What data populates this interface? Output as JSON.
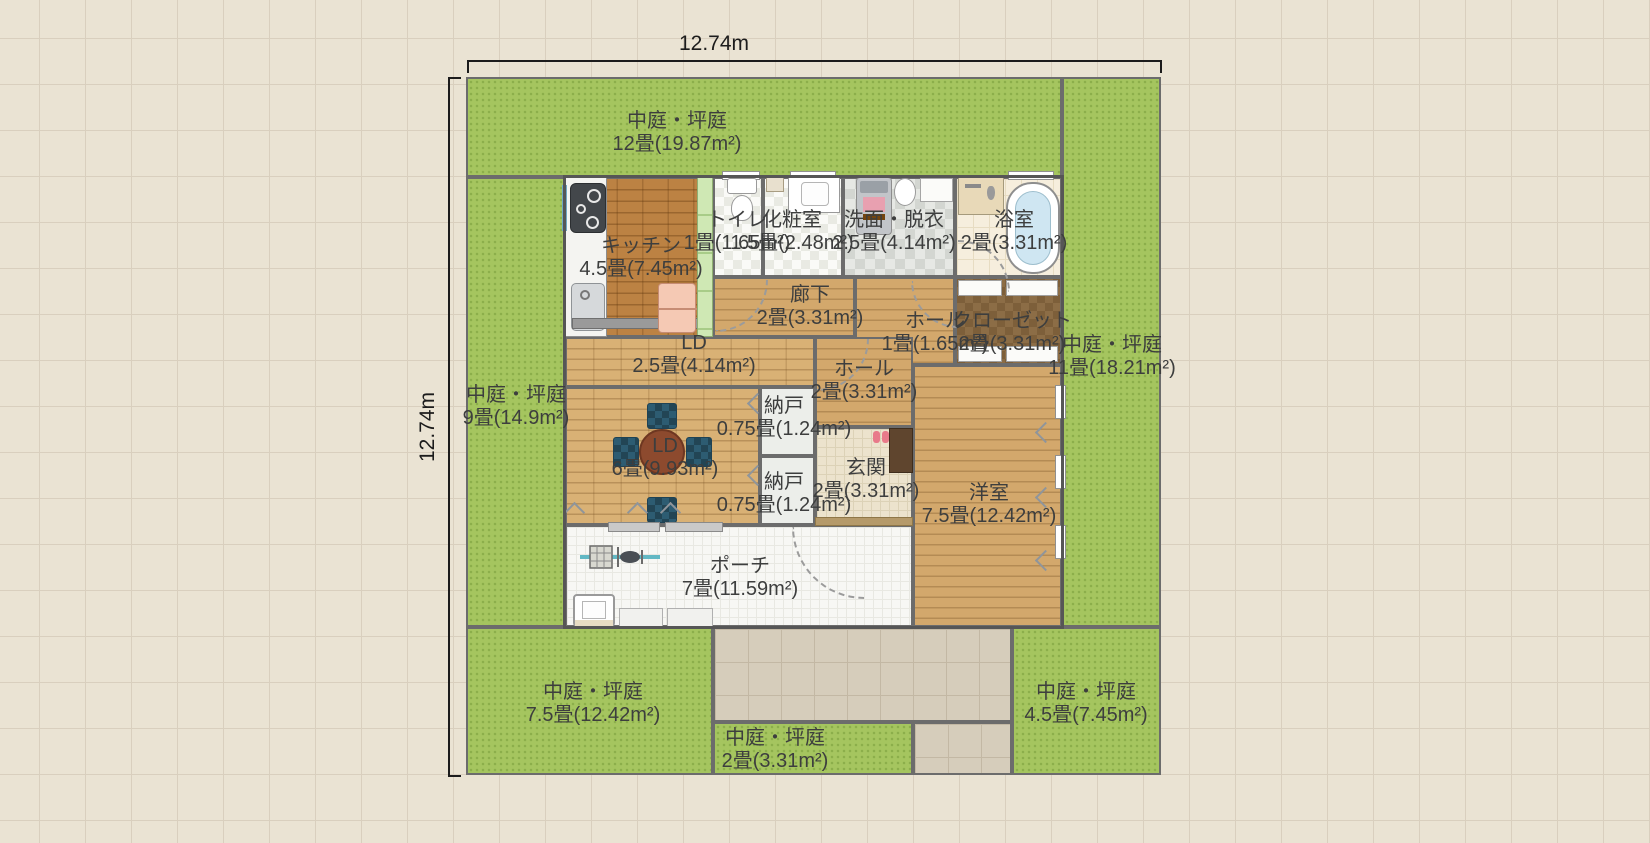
{
  "dimensions": {
    "width": "12.74m",
    "height": "12.74m"
  },
  "areas": {
    "courtyard_top": {
      "name": "中庭・坪庭",
      "size": "12畳(19.87m²)"
    },
    "courtyard_right": {
      "name": "中庭・坪庭",
      "size": "11畳(18.21m²)"
    },
    "courtyard_left": {
      "name": "中庭・坪庭",
      "size": "9畳(14.9m²)"
    },
    "courtyard_bottom_left": {
      "name": "中庭・坪庭",
      "size": "7.5畳(12.42m²)"
    },
    "courtyard_bottom_center": {
      "name": "中庭・坪庭",
      "size": "2畳(3.31m²)"
    },
    "courtyard_bottom_right": {
      "name": "中庭・坪庭",
      "size": "4.5畳(7.45m²)"
    },
    "kitchen": {
      "name": "キッチン",
      "size": "4.5畳(7.45m²)"
    },
    "toilet": {
      "name": "トイレ",
      "size": "1畳(1.65m²)"
    },
    "powder_room": {
      "name": "化粧室",
      "size": "1.5畳(2.48m²)"
    },
    "washroom": {
      "name": "洗面・脱衣",
      "size": "2.5畳(4.14m²)"
    },
    "bathroom": {
      "name": "浴室",
      "size": "2畳(3.31m²)"
    },
    "corridor": {
      "name": "廊下",
      "size": "2畳(3.31m²)"
    },
    "hall_upper": {
      "name": "ホール",
      "size": "1畳(1.65m²)"
    },
    "closet": {
      "name": "クローゼット",
      "size": "2畳(3.31m²)"
    },
    "ld_upper": {
      "name": "LD",
      "size": "2.5畳(4.14m²)"
    },
    "hall_lower": {
      "name": "ホール",
      "size": "2畳(3.31m²)"
    },
    "ld_main": {
      "name": "LD",
      "size": "6畳(9.93m²)"
    },
    "storage_upper": {
      "name": "納戸",
      "size": "0.75畳(1.24m²)"
    },
    "storage_lower": {
      "name": "納戸",
      "size": "0.75畳(1.24m²)"
    },
    "entrance": {
      "name": "玄関",
      "size": "2畳(3.31m²)"
    },
    "western_room": {
      "name": "洋室",
      "size": "7.5畳(12.42m²)"
    },
    "porch": {
      "name": "ポーチ",
      "size": "7畳(11.59m²)"
    }
  },
  "fixtures": [
    "gas-stove",
    "kitchen-sink",
    "refrigerator",
    "pantry-cabinet",
    "toilet",
    "vanity-sink",
    "washing-machine",
    "wash-basin",
    "shower-panel",
    "bathtub",
    "dining-table",
    "chair",
    "bicycle",
    "garden-sink",
    "bench",
    "shoe-cabinet",
    "slippers"
  ],
  "colors": {
    "background": "#eae3d3",
    "grass": "#a5c55f",
    "wood": "#d3a86c",
    "kitchen_floor": "#bc8243",
    "wall": "#565656",
    "path": "#d6cdbb",
    "label_text": "#3d3e3e"
  }
}
